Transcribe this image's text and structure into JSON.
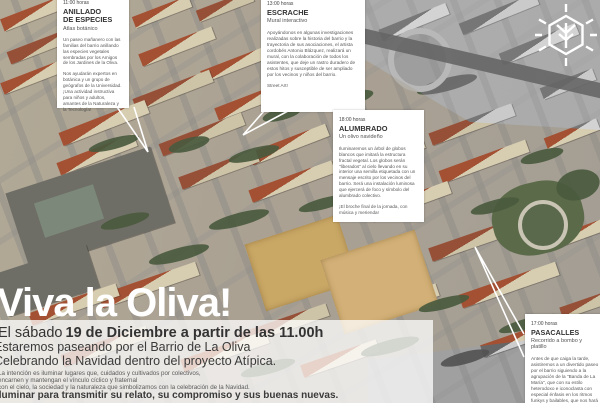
{
  "poster": {
    "title": "Viva la Oliva!",
    "date_line_prefix": "El sábado",
    "date_line_bold": "19 de Diciembre a partir de las 11.00h",
    "intro_line_2": "Estaremos paseando por el Barrio de La Oliva",
    "intro_line_3": "Celebrando la Navidad dentro del proyecto Atípica.",
    "small_lines": [
      "La intención es iluminar lugares que, cuidados y cultivados por colectivos,",
      "encarnen y mantengan el vínculo cíclico y fraternal",
      "con el cielo, la sociedad y la naturaleza que simbolizamos con la celebración de la Navidad."
    ],
    "emphasis_line": "Iluminar para transmitir su relato, su compromiso y sus buenas nuevas."
  },
  "callouts": [
    {
      "time": "11:00 horas",
      "title": "ANILLADO DE ESPECIES",
      "subtitle": "Atlas botánico",
      "paragraphs": [
        "Un paseo mañanero con las familias del barrio anillando las especies vegetales sembradas por los Amigos de los Jardines de la Oliva.",
        "Nos ayudarán expertos en botánica y un grupo de geógrafos de la Universidad. ¡Una actividad instructiva para niños y adultos, amantes de la Naturaleza y la Tecnología!"
      ]
    },
    {
      "time": "13:00 horas",
      "title": "ESCRACHE",
      "subtitle": "Mural interactivo",
      "paragraphs": [
        "Apoyándonos en algunas investigaciones realizadas sobre la historia del barrio y la trayectoria de sus asociaciones, el artista cordobés Antonio Blázquez, realizará un mural, con la colaboración de todos los asistentes, que deje un rastro duradero de estos hitos y susceptible de ser ampliado por los vecinos y niños del barrio.",
        "Street Art!"
      ]
    },
    {
      "time": "18:00 horas",
      "title": "ALUMBRADO",
      "subtitle": "Un olivo navideño",
      "paragraphs": [
        "Iluminaremos un árbol de globos blancos que imitará la estructura fractal vegetal. Los globos serán \"liberados\" al cielo llevando en su interior una semilla etiquetada con un mensaje escrito por los vecinos del barrio. Será una instalación luminosa que ejercerá de foco y símbolo del alumbrado colectivo.",
        "¡El broche final de la jornada, con música y merienda!"
      ]
    },
    {
      "time": "17:00 horas",
      "title": "PASACALLES",
      "subtitle": "Recorrido a bombo y platillo",
      "paragraphs": [
        "Antes de que caiga la tarde, asistiremos a un divertido paseo por el barrio siguiendo a la agrupación de la \"Banda de La María\", que con su estilo heterodoxo e iconoclasta con especial énfasis en los ritmos funkys y bailables, que nos hará pasar un rato inolvidable, de música y"
      ]
    }
  ],
  "logo_icon": "tree-hexagon-snowflake",
  "colors": {
    "panel": "#ffffff",
    "heading_text": "#333333",
    "body_text": "#555555",
    "roof_red": "#a45033",
    "wall_beige": "#d7cdb1",
    "sand_field": "#c9a765"
  }
}
